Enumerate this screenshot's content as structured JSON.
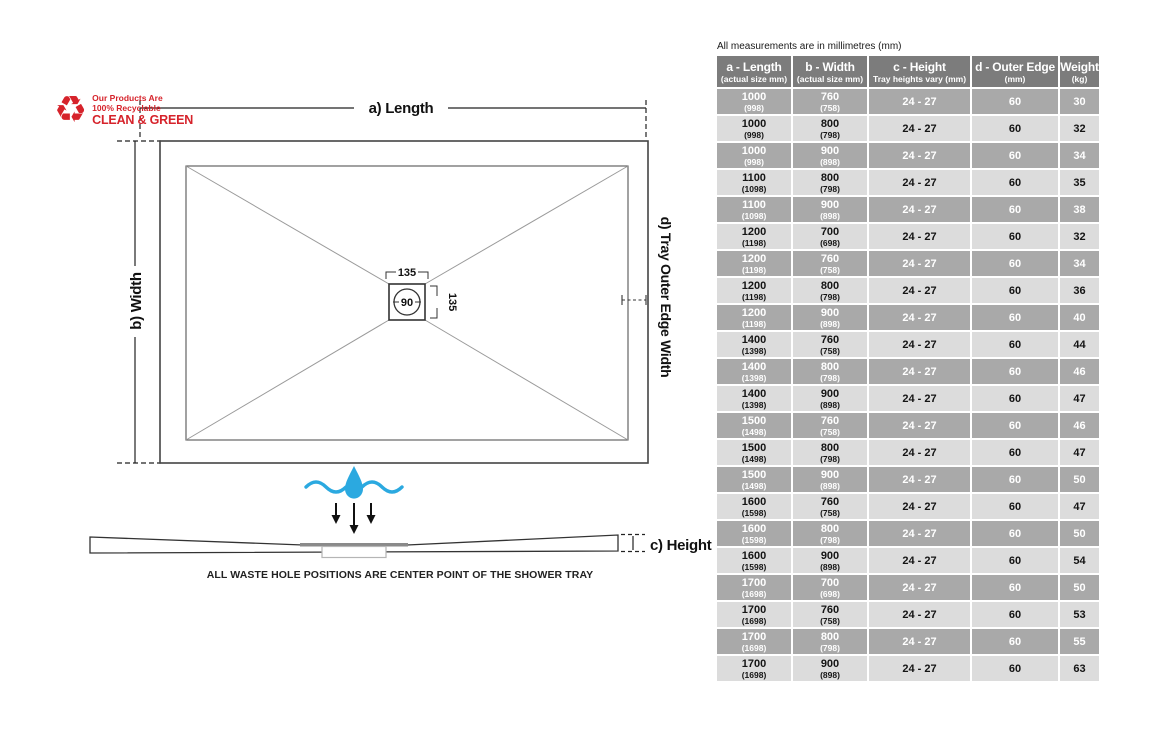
{
  "note": "All measurements are in millimetres (mm)",
  "logo": {
    "line1": "Our Products Are",
    "line2": "100% Recyclable",
    "line3": "CLEAN & GREEN"
  },
  "diagram": {
    "length_label": "a) Length",
    "width_label": "b) Width",
    "height_label": "c) Height",
    "outer_edge_label": "d) Tray Outer Edge Width",
    "waste_dim_top": "135",
    "waste_dim_side": "135",
    "waste_diameter": "90",
    "caption": "ALL WASTE HOLE POSITIONS ARE CENTER POINT OF THE SHOWER TRAY"
  },
  "colors": {
    "accent_red": "#d6232b",
    "water_blue": "#2ba9e0",
    "header_bg": "#7c7c7c",
    "row_dark_bg": "#a9a9a9",
    "row_light_bg": "#dcdcdc"
  },
  "table": {
    "columns": [
      {
        "title": "a - Length",
        "subtitle": "(actual size mm)"
      },
      {
        "title": "b - Width",
        "subtitle": "(actual size mm)"
      },
      {
        "title": "c - Height",
        "subtitle": "Tray heights vary (mm)"
      },
      {
        "title": "d - Outer Edge",
        "subtitle": "(mm)"
      },
      {
        "title": "Weight",
        "subtitle": "(kg)"
      }
    ],
    "rows": [
      {
        "length": "1000",
        "length_actual": "(998)",
        "width": "760",
        "width_actual": "(758)",
        "height": "24 - 27",
        "outer_edge": "60",
        "weight": "30"
      },
      {
        "length": "1000",
        "length_actual": "(998)",
        "width": "800",
        "width_actual": "(798)",
        "height": "24 - 27",
        "outer_edge": "60",
        "weight": "32"
      },
      {
        "length": "1000",
        "length_actual": "(998)",
        "width": "900",
        "width_actual": "(898)",
        "height": "24 - 27",
        "outer_edge": "60",
        "weight": "34"
      },
      {
        "length": "1100",
        "length_actual": "(1098)",
        "width": "800",
        "width_actual": "(798)",
        "height": "24 - 27",
        "outer_edge": "60",
        "weight": "35"
      },
      {
        "length": "1100",
        "length_actual": "(1098)",
        "width": "900",
        "width_actual": "(898)",
        "height": "24 - 27",
        "outer_edge": "60",
        "weight": "38"
      },
      {
        "length": "1200",
        "length_actual": "(1198)",
        "width": "700",
        "width_actual": "(698)",
        "height": "24 - 27",
        "outer_edge": "60",
        "weight": "32"
      },
      {
        "length": "1200",
        "length_actual": "(1198)",
        "width": "760",
        "width_actual": "(758)",
        "height": "24 - 27",
        "outer_edge": "60",
        "weight": "34"
      },
      {
        "length": "1200",
        "length_actual": "(1198)",
        "width": "800",
        "width_actual": "(798)",
        "height": "24 - 27",
        "outer_edge": "60",
        "weight": "36"
      },
      {
        "length": "1200",
        "length_actual": "(1198)",
        "width": "900",
        "width_actual": "(898)",
        "height": "24 - 27",
        "outer_edge": "60",
        "weight": "40"
      },
      {
        "length": "1400",
        "length_actual": "(1398)",
        "width": "760",
        "width_actual": "(758)",
        "height": "24 - 27",
        "outer_edge": "60",
        "weight": "44"
      },
      {
        "length": "1400",
        "length_actual": "(1398)",
        "width": "800",
        "width_actual": "(798)",
        "height": "24 - 27",
        "outer_edge": "60",
        "weight": "46"
      },
      {
        "length": "1400",
        "length_actual": "(1398)",
        "width": "900",
        "width_actual": "(898)",
        "height": "24 - 27",
        "outer_edge": "60",
        "weight": "47"
      },
      {
        "length": "1500",
        "length_actual": "(1498)",
        "width": "760",
        "width_actual": "(758)",
        "height": "24 - 27",
        "outer_edge": "60",
        "weight": "46"
      },
      {
        "length": "1500",
        "length_actual": "(1498)",
        "width": "800",
        "width_actual": "(798)",
        "height": "24 - 27",
        "outer_edge": "60",
        "weight": "47"
      },
      {
        "length": "1500",
        "length_actual": "(1498)",
        "width": "900",
        "width_actual": "(898)",
        "height": "24 - 27",
        "outer_edge": "60",
        "weight": "50"
      },
      {
        "length": "1600",
        "length_actual": "(1598)",
        "width": "760",
        "width_actual": "(758)",
        "height": "24 - 27",
        "outer_edge": "60",
        "weight": "47"
      },
      {
        "length": "1600",
        "length_actual": "(1598)",
        "width": "800",
        "width_actual": "(798)",
        "height": "24 - 27",
        "outer_edge": "60",
        "weight": "50"
      },
      {
        "length": "1600",
        "length_actual": "(1598)",
        "width": "900",
        "width_actual": "(898)",
        "height": "24 - 27",
        "outer_edge": "60",
        "weight": "54"
      },
      {
        "length": "1700",
        "length_actual": "(1698)",
        "width": "700",
        "width_actual": "(698)",
        "height": "24 - 27",
        "outer_edge": "60",
        "weight": "50"
      },
      {
        "length": "1700",
        "length_actual": "(1698)",
        "width": "760",
        "width_actual": "(758)",
        "height": "24 - 27",
        "outer_edge": "60",
        "weight": "53"
      },
      {
        "length": "1700",
        "length_actual": "(1698)",
        "width": "800",
        "width_actual": "(798)",
        "height": "24 - 27",
        "outer_edge": "60",
        "weight": "55"
      },
      {
        "length": "1700",
        "length_actual": "(1698)",
        "width": "900",
        "width_actual": "(898)",
        "height": "24 - 27",
        "outer_edge": "60",
        "weight": "63"
      }
    ]
  }
}
